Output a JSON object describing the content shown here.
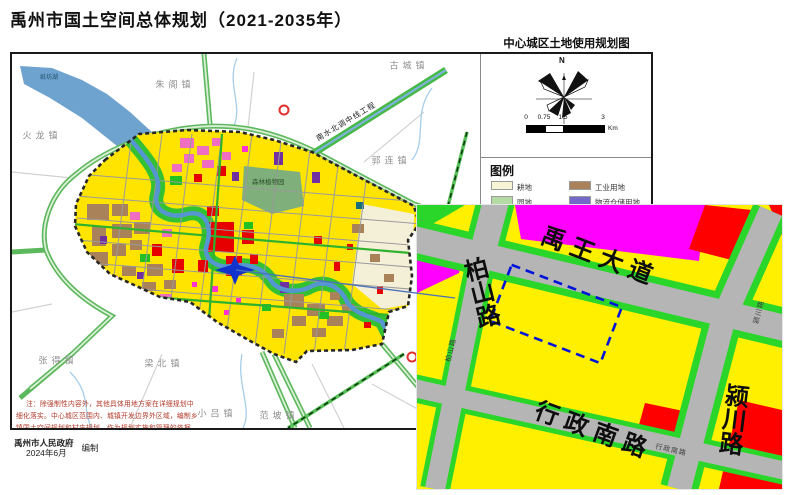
{
  "title": "禹州市国土空间总体规划（2021-2035年）",
  "map": {
    "towns": [
      "朱阁镇",
      "古城镇",
      "火龙镇",
      "郭连镇",
      "张得镇",
      "梁北镇",
      "小吕镇",
      "范坡镇"
    ],
    "water_label": "纸坊湖",
    "canal_label": "南水北调中线工程",
    "park_label": "森林植物园",
    "note_line1": "注：除强制性内容外，其他具体用地方案在详细规划中",
    "note_line2": "细化落实。中心城区范围内、城镇开发边界外区域，编制乡",
    "note_line3": "镇国土空间规划和村庄规划，作为规划实施和管理的依据。",
    "credit_org": "禹州市人民政府",
    "credit_date": "2024年6月",
    "credit_role": "编制",
    "marker": "site-star"
  },
  "panel": {
    "title": "中心城区土地使用规划图",
    "compass_label": "N",
    "scale_ticks": [
      "0",
      "0.75",
      "1.5",
      "3"
    ],
    "scale_unit": "Km",
    "legend_title": "图例",
    "legend_items": [
      {
        "label": "耕地",
        "color": "#F7F4D5"
      },
      {
        "label": "工业用地",
        "color": "#A9825A"
      },
      {
        "label": "园地",
        "color": "#B5DBA5"
      },
      {
        "label": "物流仓储用地",
        "color": "#7468C8"
      }
    ]
  },
  "inset": {
    "roads": {
      "yuwang": "禹王大道",
      "baishan": "柏山路",
      "xingzheng": "行政南路",
      "yingchuan": "颍川路"
    },
    "colors": {
      "residential_yellow": "#FFF000",
      "commercial_magenta": "#FF00FF",
      "public_red": "#FF0000",
      "green_verge": "#2BD62B",
      "road_gray": "#B5B5B5",
      "site_outline_blue": "#0013D9"
    }
  }
}
